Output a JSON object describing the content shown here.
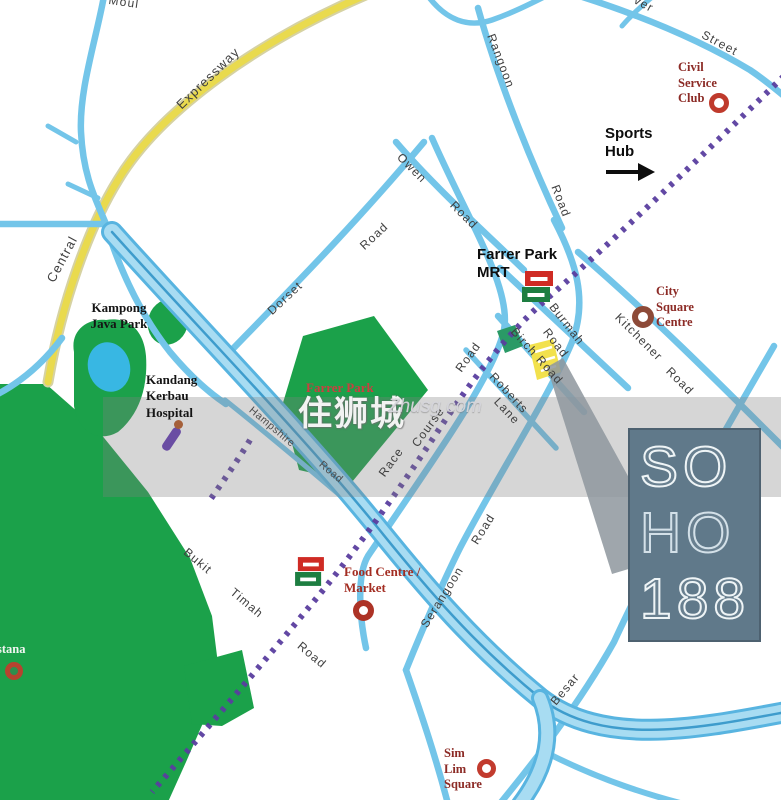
{
  "watermark": {
    "cjk": "住狮城",
    "latin": "Zhusg.com"
  },
  "logo": {
    "line1": "SO",
    "line2": "HO",
    "line3": "188"
  },
  "landmarks": {
    "kampong_java_park": [
      "Kampong",
      "Java Park"
    ],
    "kandang_kerbau_hospital": [
      "Kandang",
      "Kerbau",
      "Hospital"
    ],
    "farrer_park": "Farrer Park",
    "farrer_park_mrt": [
      "Farrer Park",
      "MRT"
    ],
    "sports_hub": [
      "Sports",
      "Hub"
    ],
    "civil_service_club": [
      "Civil",
      "Service",
      "Club"
    ],
    "city_square_centre": [
      "City",
      "Square",
      "Centre"
    ],
    "food_centre_market": [
      "Food Centre /",
      "Market"
    ],
    "sim_lim_square": [
      "Sim",
      "Lim",
      "Square"
    ],
    "istana_partial": "stana"
  },
  "roads": {
    "moulmein_partial": "Moul",
    "expressway": "Expressway",
    "central": "Central",
    "rangoon": "Rangoon",
    "rangoon_suffix": "Road",
    "street_partial": "ver",
    "street": "Street",
    "owen": "Owen",
    "owen_suffix": "Road",
    "dorset": "Dorset",
    "dorset_suffix": "Road",
    "race": "Race",
    "course": "Course",
    "race_suffix": "Road",
    "birch_road": "Birch Road",
    "burmah": "Burmah",
    "burmah_suffix": "Road",
    "kitchener": "Kitchener",
    "kitchener_suffix": "Road",
    "roberts": "Roberts",
    "roberts_suffix": "Lane",
    "serangoon": "Serangoon",
    "serangoon_suffix": "Road",
    "bukit": "Bukit",
    "timah": "Timah",
    "bukit_suffix": "Road",
    "besar": "Besar",
    "hampshire": "Hampshire",
    "hampshire_suffix": "Road"
  },
  "icons": [
    "mrt-station-icon",
    "landmark-ring-icon",
    "hospital-marker-icon",
    "direction-arrow-icon"
  ],
  "colors": {
    "road_blue": "#73c5e9",
    "road_blue_dark": "#3e9ccc",
    "expressway_yellow": "#e9da4e",
    "park_green": "#1ba14a",
    "pond_blue": "#38b7e3",
    "mrt_purple": "#5a3e9f",
    "landmark_maroon": "#8c2b26",
    "landmark_red": "#c84040",
    "site_yellow": "#f2e14d",
    "logo_bg": "#60798a",
    "logo_stroke": "#eef4f6",
    "band_gray": "#808080"
  }
}
